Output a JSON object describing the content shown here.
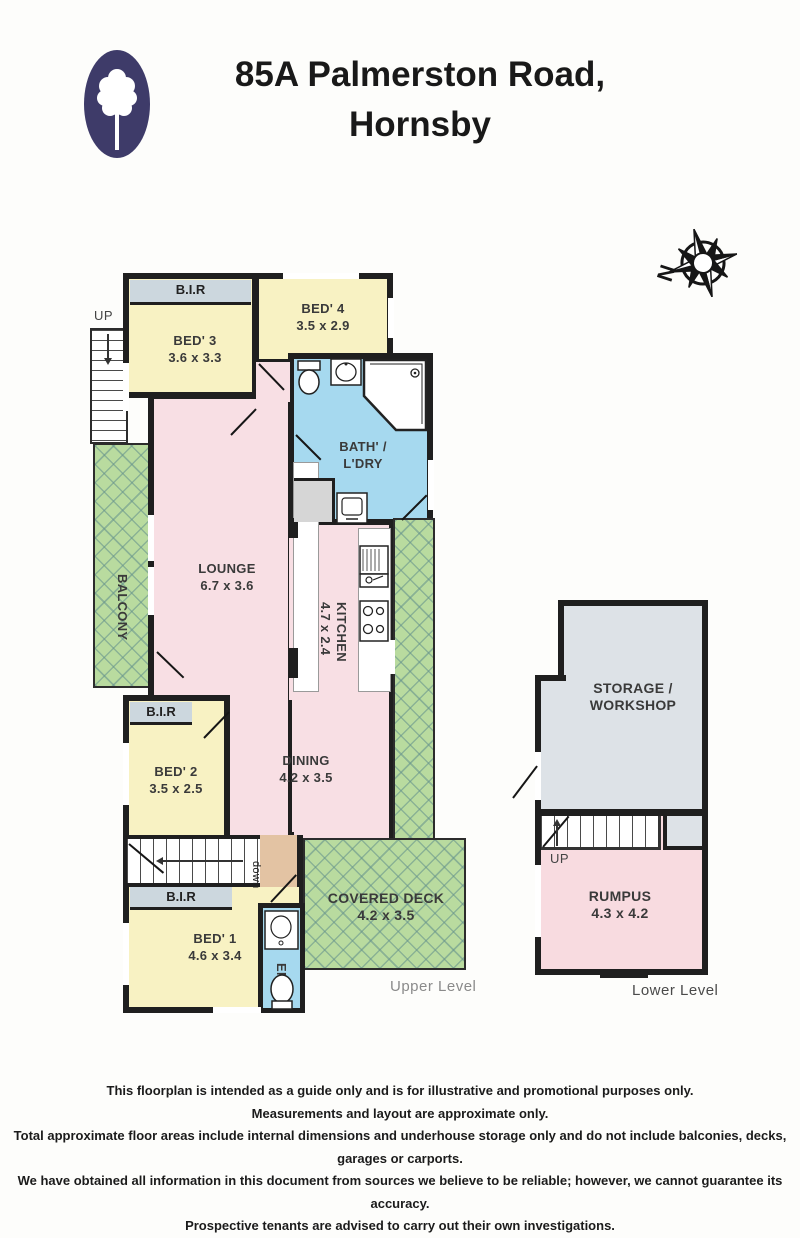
{
  "header": {
    "title_line1": "85A Palmerston Road,",
    "title_line2": "Hornsby"
  },
  "compass": {
    "north_label": "N"
  },
  "upper_level": {
    "level_label": "Upper Level",
    "stairs_up": "UP",
    "stairs_down": "down",
    "bir1": "B.I.R",
    "bir2": "B.I.R",
    "bir3": "B.I.R",
    "bed3_name": "BED' 3",
    "bed3_dims": "3.6 x 3.3",
    "bed4_name": "BED' 4",
    "bed4_dims": "3.5 x 2.9",
    "bath_name_line1": "BATH' /",
    "bath_name_line2": "L'DRY",
    "balcony": "BALCONY",
    "lounge_name": "LOUNGE",
    "lounge_dims": "6.7 x 3.6",
    "kitchen_name": "KITCHEN",
    "kitchen_dims": "4.7 x 2.4",
    "bed2_name": "BED' 2",
    "bed2_dims": "3.5 x 2.5",
    "dining_name": "DINING",
    "dining_dims": "4.2 x 3.5",
    "bed1_name": "BED' 1",
    "bed1_dims": "4.6 x 3.4",
    "ens": "ENS",
    "deck_name": "COVERED DECK",
    "deck_dims": "4.2 x 3.5"
  },
  "lower_level": {
    "level_label": "Lower Level",
    "stairs_up": "UP",
    "storage_name_line1": "STORAGE /",
    "storage_name_line2": "WORKSHOP",
    "rumpus_name": "RUMPUS",
    "rumpus_dims": "4.3 x 4.2"
  },
  "footer": {
    "lines": [
      "This floorplan is intended as a guide only and is for illustrative and promotional purposes only.",
      "Measurements and layout are approximate only.",
      "Total approximate floor areas include internal dimensions and underhouse storage only and do not include balconies, decks, garages or carports.",
      "We have obtained all information in this document from sources we believe to be reliable; however, we cannot guarantee its accuracy.",
      "Prospective tenants are advised to carry out their own investigations."
    ]
  },
  "colors": {
    "logo": "#3e3b69",
    "bedroom_yellow": "#f8f2c3",
    "living_pink": "#f8dfe4",
    "wet_blue": "#a6d9ef",
    "outdoor_green": "#b9db9f",
    "storage_grey": "#dde2e7",
    "bir_band": "#ccd7de",
    "landing_tan": "#e3c3a3",
    "wall": "#1f1f1f"
  }
}
